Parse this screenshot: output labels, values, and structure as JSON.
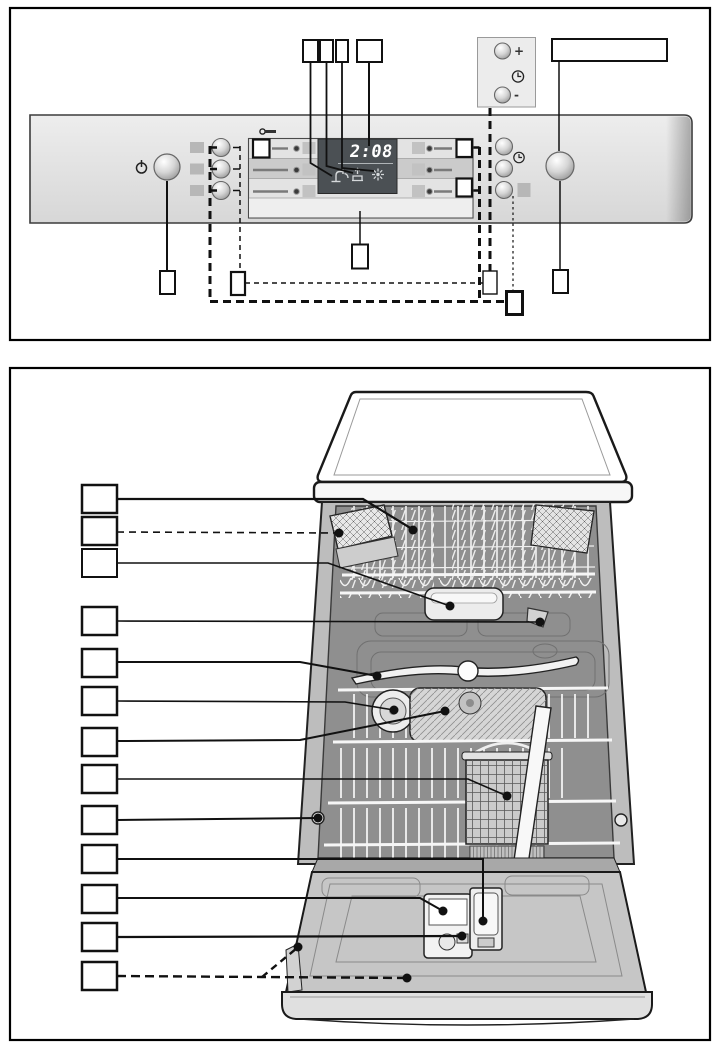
{
  "figure": {
    "kind": "appliance-manual-diagram",
    "sections": [
      "control-panel-callouts",
      "interior-view-callouts"
    ]
  },
  "control_panel": {
    "display": {
      "time": "2:08"
    },
    "timer_inset": {
      "plus_label": "+",
      "minus_label": "-"
    },
    "icons": [
      "power-icon",
      "childlock-key-icon",
      "clock-icon",
      "clock-icon-small",
      "water-tap-icon",
      "salt-refill-icon",
      "rinse-aid-icon"
    ],
    "buttons": {
      "left_round_buttons": 3,
      "right_round_buttons": 3,
      "program_buttons": 3,
      "power_button": 1,
      "start_button": 1,
      "plus_button": 1,
      "minus_button": 1
    },
    "callout_boxes_top": 4,
    "callout_boxes_bottom": 6,
    "wide_callout_box": 1
  },
  "interior_view": {
    "callout_boxes": 13,
    "dashed_callouts": [
      2,
      13
    ],
    "parts": [
      "top-basket",
      "knife-shelf",
      "top-spray-tray",
      "upper-nozzle",
      "middle-spray-arm",
      "salt-cap",
      "filter-tray",
      "cutlery-basket",
      "basket-roller",
      "rinse-aid-dispenser",
      "detergent-dispenser",
      "dispenser-latch",
      "inner-door"
    ]
  },
  "colors": {
    "panel": "#e2e2e2",
    "display_bg": "#4b5054",
    "display_text": "#ffffff",
    "outline": "#111111",
    "wire": "#f4f4f4",
    "interior": "#8f8f8f"
  }
}
